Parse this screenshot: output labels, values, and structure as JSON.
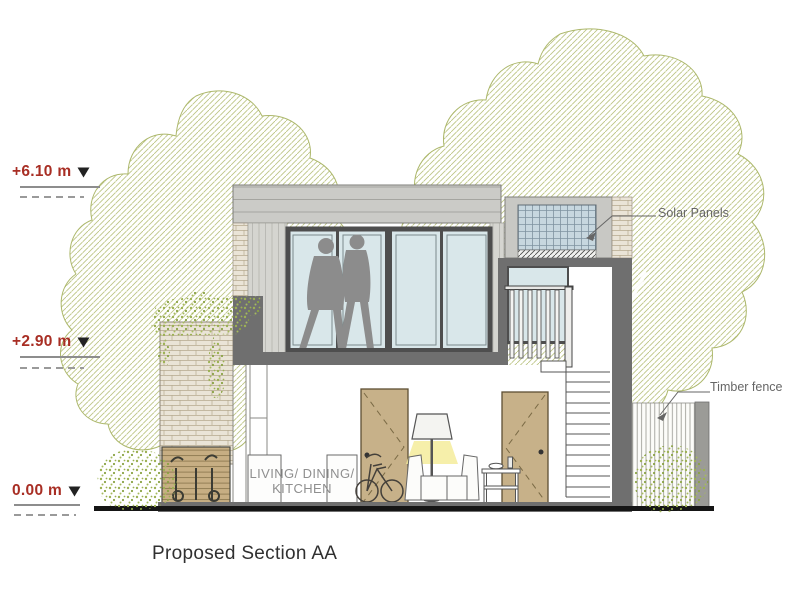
{
  "title": "Proposed Section AA",
  "levels": [
    {
      "id": "roof",
      "label": "+6.10 m"
    },
    {
      "id": "first-floor",
      "label": "+2.90 m"
    },
    {
      "id": "ground",
      "label": "0.00 m"
    }
  ],
  "annotations": {
    "solar_panels": "Solar Panels",
    "timber_fence": "Timber fence"
  },
  "room_label": {
    "line1": "LIVING/ DINING/",
    "line2": "KITCHEN"
  },
  "colors": {
    "level_marker_red": "#a82e24",
    "tree_hatch_olive": "#bcc484",
    "foliage_green": "#9cb153",
    "cut_wall_grey": "#6f6f6f",
    "window_glass": "#d9e7ea",
    "window_frame": "#4e4e4e",
    "door_timber": "#c7b189",
    "brick_beige": "#eae4d7",
    "solar_panel_blue": "#c7d7df",
    "lamp_glow_yellow": "#f5ec9b",
    "ground_line_black": "#151515",
    "annotation_grey": "#666666",
    "room_text_grey": "#8f8f8f"
  }
}
